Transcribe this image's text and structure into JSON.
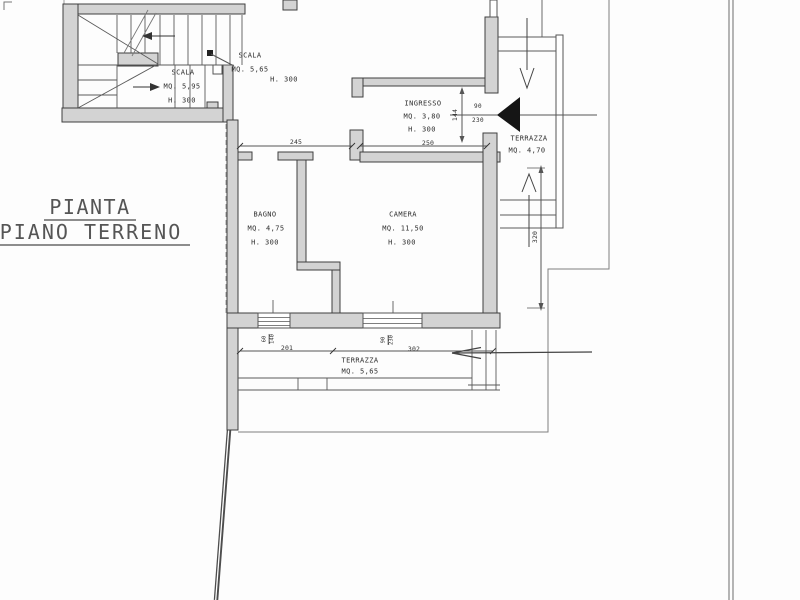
{
  "document_type": "architectural-floor-plan",
  "title": {
    "line1": "PIANTA",
    "line2": "PIANO TERRENO"
  },
  "labels": {
    "scala_upper": {
      "name": "SCALA",
      "area": "MQ. 5,65",
      "height": "H. 300"
    },
    "scala_lower": {
      "name": "SCALA",
      "area": "MQ. 5,95",
      "height": "H. 300"
    },
    "ingresso": {
      "name": "INGRESSO",
      "area": "MQ. 3,80",
      "height": "H. 300"
    },
    "terrazza_upper": {
      "name": "TERRAZZA",
      "area": "MQ. 4,70"
    },
    "bagno": {
      "name": "BAGNO",
      "area": "MQ. 4,75",
      "height": "H. 300"
    },
    "camera": {
      "name": "CAMERA",
      "area": "MQ. 11,50",
      "height": "H. 300"
    },
    "terrazza_lower": {
      "name": "TERRAZZA",
      "area": "MQ. 5,65"
    }
  },
  "dimensions": {
    "corridor_width": "245",
    "ingresso_width": "250",
    "ingresso_depth": "144",
    "side_depth": "320",
    "terrace_span_left": "201",
    "terrace_span_right": "302"
  },
  "openings": {
    "ingresso_door": {
      "width": "90",
      "height": "230"
    },
    "bagno_window": {
      "width": "60",
      "height": "140"
    },
    "camera_door": {
      "width": "90",
      "height": "230"
    }
  },
  "colors": {
    "wall_fill": "#d3d3d3",
    "wall_stroke": "#3f3f3f",
    "line": "#5a5a5a",
    "door_leaf": "#151515"
  }
}
